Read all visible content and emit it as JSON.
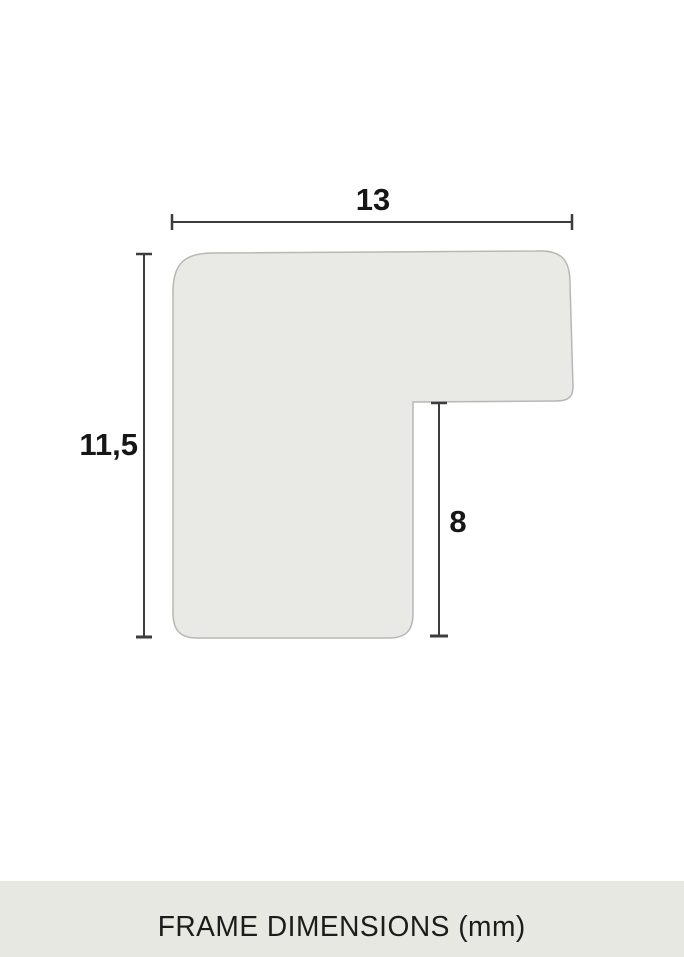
{
  "diagram": {
    "width_label": "13",
    "height_label": "11,5",
    "notch_label": "8"
  },
  "footer": {
    "title": "FRAME DIMENSIONS (mm)"
  },
  "colors": {
    "page_bg": "#ffffff",
    "shape_fill": "#e9e9e5",
    "shape_stroke": "#b7b7b3",
    "dimension_line": "#3d3d3d",
    "label_text": "#161616",
    "footer_bg": "#e8e8e3",
    "footer_text": "#1c1c1c"
  }
}
